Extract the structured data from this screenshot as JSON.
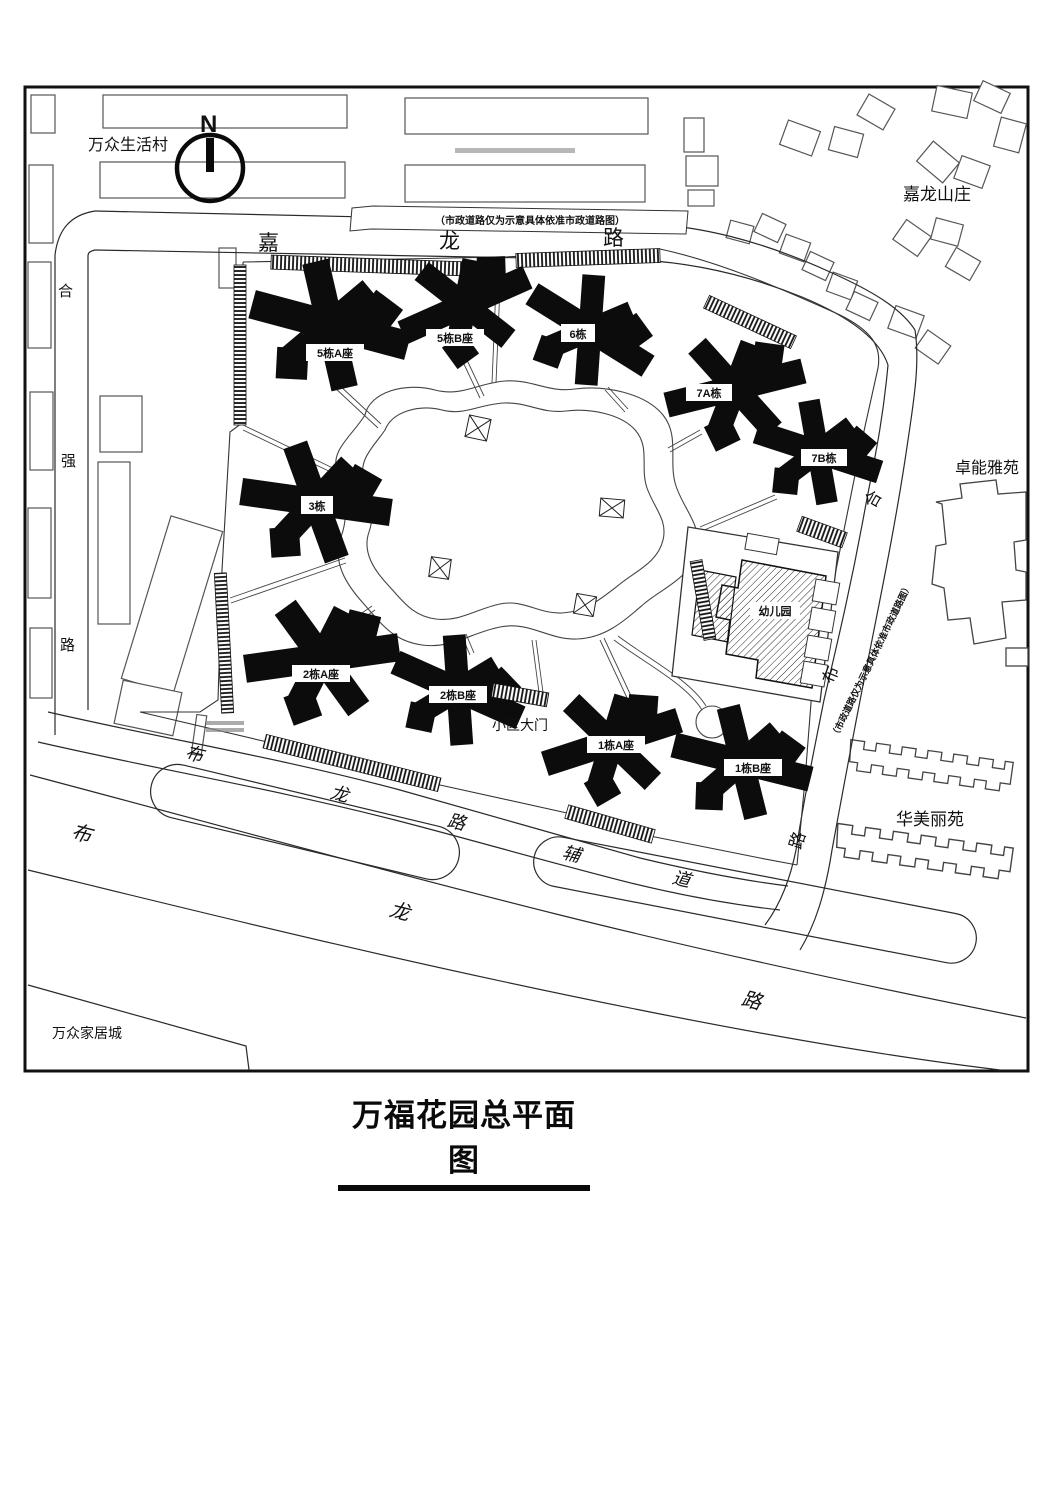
{
  "title": "万福花园总平面图",
  "compass": {
    "north": "N"
  },
  "notes": {
    "road_note_top": "（市政道路仅为示意具体依准市政道路图）",
    "road_note_right": "（市政道路仅为示意具体依准市政道路图）"
  },
  "neighborhoods": {
    "wanzhong_village": "万众生活村",
    "jialong_villas": "嘉龙山庄",
    "zhuoneng_garden": "卓能雅苑",
    "huameili_garden": "华美丽苑",
    "wanzhong_home_city": "万众家居城"
  },
  "roads": {
    "jialong": {
      "chars": [
        "嘉",
        "龙",
        "路"
      ]
    },
    "heqiang": {
      "chars": [
        "合",
        "强",
        "路"
      ]
    },
    "east": {
      "chars": [
        "合",
        "布",
        "路"
      ]
    },
    "bulong_service": {
      "chars": [
        "布",
        "龙",
        "路",
        "辅",
        "道"
      ]
    },
    "bulong": {
      "chars": [
        "布",
        "龙",
        "路"
      ]
    }
  },
  "buildings": {
    "b5a": "5栋A座",
    "b5b": "5栋B座",
    "b6": "6栋",
    "b7a": "7A栋",
    "b7b": "7B栋",
    "b3": "3栋",
    "b2a": "2栋A座",
    "b2b": "2栋B座",
    "b1a": "1栋A座",
    "b1b": "1栋B座",
    "kindergarten": "幼儿园"
  },
  "gate": {
    "label": "小区大门"
  }
}
